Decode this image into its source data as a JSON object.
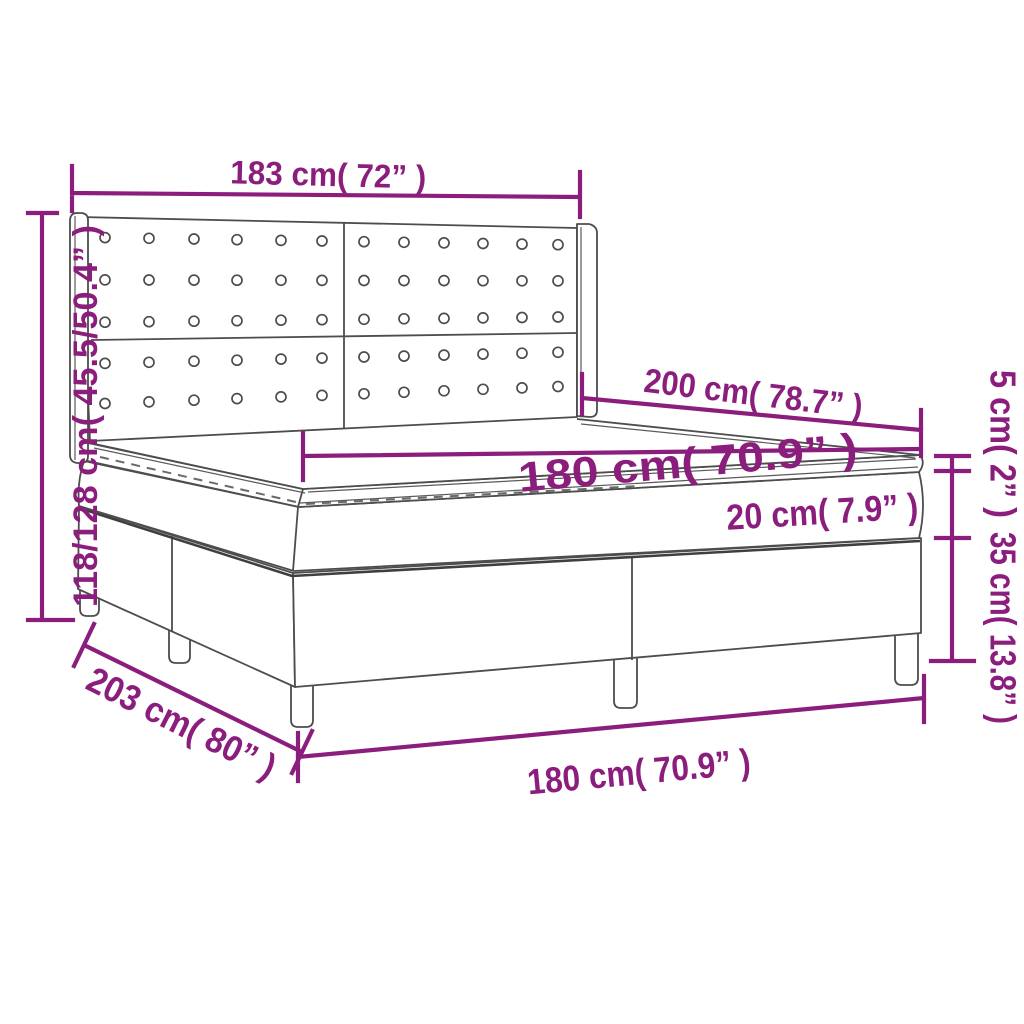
{
  "diagram": {
    "title": "box-spring-bed-dimension-diagram",
    "colors": {
      "dimension": "#8b1e7d",
      "drawing_line": "#4d4d4d",
      "background": "#ffffff"
    },
    "labels": {
      "headboard_width": "183 cm( 72” )",
      "total_height": "118/128 cm( 45.5/50.4” )",
      "bed_length": "200 cm( 78.7” )",
      "mattress_width": "180 cm( 70.9” )",
      "mattress_thickness": "20 cm( 7.9” )",
      "topper_thickness": "5 cm( 2” )",
      "base_height": "35 cm( 13.8” )",
      "total_length": "203 cm( 80” )",
      "bottom_width": "180 cm( 70.9” )"
    }
  },
  "buttons": {
    "columns": [
      105,
      149,
      194,
      237,
      281,
      322,
      364,
      404,
      444,
      483,
      522,
      558
    ],
    "row_fractions": [
      0.09,
      0.28,
      0.47,
      0.655,
      0.835
    ],
    "radius": 5
  }
}
